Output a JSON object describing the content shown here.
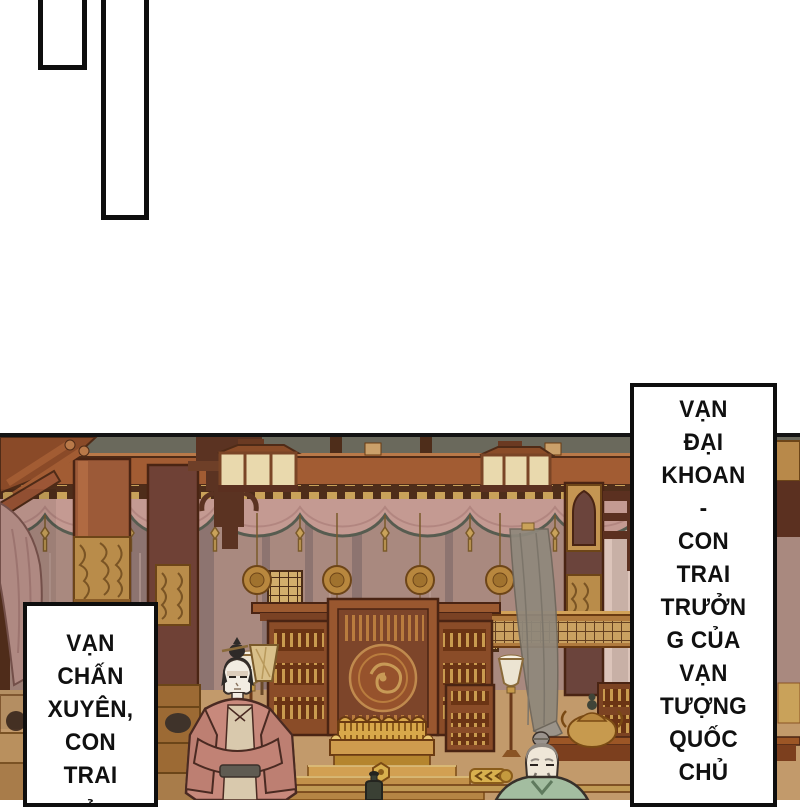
{
  "speech": {
    "left": {
      "lines": [
        "VẠN",
        "CHẤN",
        "XUYÊN,",
        "CON",
        "TRAI",
        "CỦA"
      ]
    },
    "right": {
      "lines": [
        "VẠN",
        "ĐẠI",
        "KHOAN",
        "-",
        "CON",
        "TRAI",
        "TRƯỞN",
        "G CỦA",
        "VẠN",
        "TƯỢNG",
        "QUỐC",
        "CHỦ"
      ]
    }
  },
  "palette": {
    "ink": "#0e0e0e",
    "paper": "#ffffff",
    "wood_dark": "#56301c",
    "beam_red": "#a25c33",
    "pillar_red": "#9c5a38",
    "gold": "#c49552",
    "gold_bright": "#ecd08a",
    "curtain_rose": "#c49a92",
    "curtain_trim": "#575c50",
    "wall_mauve": "#a9897f",
    "wall_pale": "#e0c9bf",
    "floor_tan": "#c29a6b",
    "throne_gold": "#d8a84a",
    "robe_salmon": "#c8897c",
    "robe_green": "#a3bda0"
  }
}
